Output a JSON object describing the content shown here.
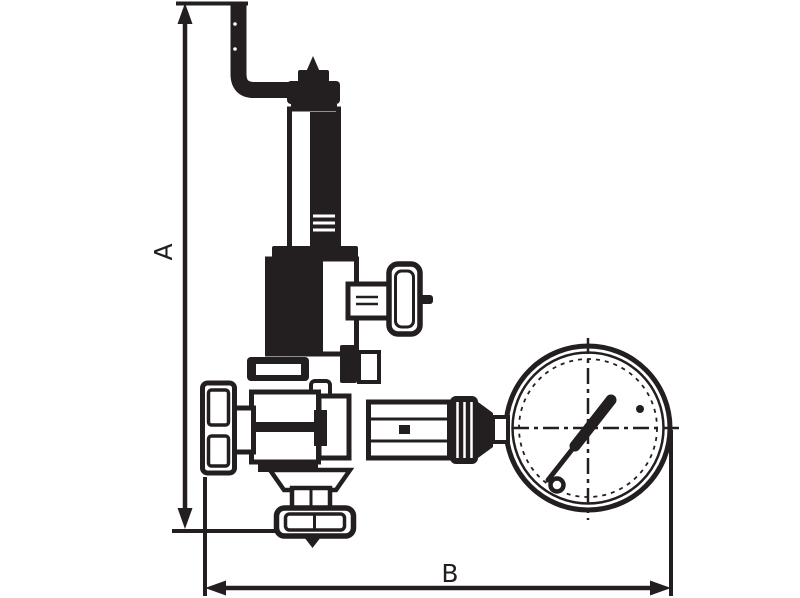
{
  "page": {
    "title": "Valve with pressure gauge - dimensional line drawing",
    "background_color": "#ffffff",
    "ink_color": "#231f20"
  },
  "dimensions": {
    "vertical": {
      "label": "A"
    },
    "horizontal": {
      "label": "B"
    }
  },
  "components": [
    {
      "name": "adjustment-rod"
    },
    {
      "name": "bonnet-cap"
    },
    {
      "name": "spring-bonnet-tube"
    },
    {
      "name": "locking-collar"
    },
    {
      "name": "spring-housing"
    },
    {
      "name": "side-t-handle"
    },
    {
      "name": "valve-body"
    },
    {
      "name": "inlet-union-nut"
    },
    {
      "name": "gauge-hex-fitting"
    },
    {
      "name": "knurled-ring"
    },
    {
      "name": "pressure-gauge"
    },
    {
      "name": "gauge-needle"
    },
    {
      "name": "bottom-outlet-flange"
    },
    {
      "name": "flow-direction-arrow"
    }
  ]
}
